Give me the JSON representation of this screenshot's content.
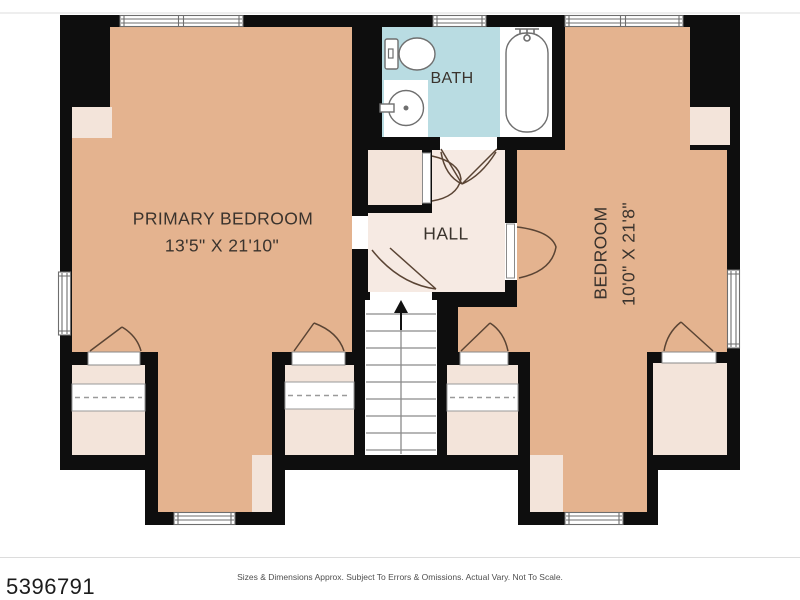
{
  "rooms": {
    "primary_bedroom": {
      "label": "PRIMARY BEDROOM",
      "dimensions": "13'5\" X 21'10\""
    },
    "bath": {
      "label": "BATH"
    },
    "hall": {
      "label": "HALL"
    },
    "bedroom": {
      "label": "BEDROOM",
      "dimensions": "10'0\" X 21'8\""
    }
  },
  "footer": {
    "listing_number": "5396791",
    "disclaimer": "Sizes & Dimensions Approx. Subject To Errors & Omissions. Actual Vary. Not To Scale."
  },
  "colors": {
    "wall": "#0e0e0e",
    "bedroom_floor": "#e4b38f",
    "hall_floor": "#f6eae3",
    "closet_floor": "#f3e4da",
    "bath_floor": "#b9dce2",
    "fixture_white": "#ffffff",
    "door_swing": "#5a4434",
    "stair_line": "#8a8a8a"
  }
}
